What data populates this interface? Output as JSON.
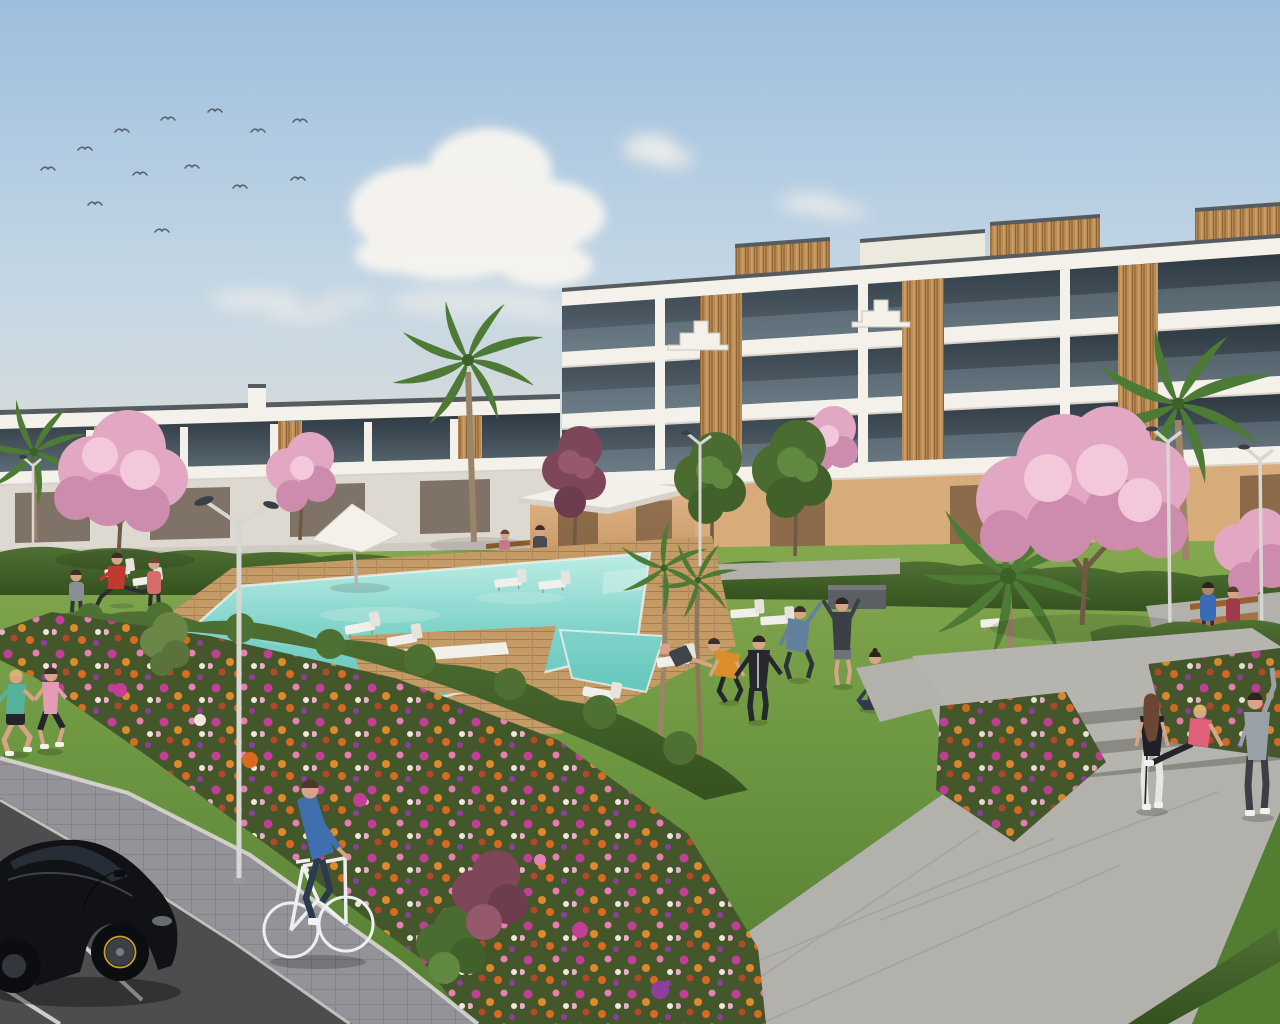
{
  "scene": {
    "type": "architectural-render",
    "description": "3D rendering of a modern white apartment complex with communal pool, timber deck, gardens, flower beds, parking lot and residents exercising",
    "environment": {
      "time_of_day": "late afternoon",
      "sky": {
        "top": "#9dbedd",
        "mid": "#c3d6e5",
        "horizon": "#ece4d7"
      },
      "clouds": [
        "large cumulus upper center-left",
        "small puffs right of center",
        "low wisps left"
      ],
      "birds_count": 13
    },
    "buildings": {
      "left_block": {
        "stories": 2,
        "style": "white terraced apartments with dark glazing and timber slat accents"
      },
      "right_block": {
        "stories": 3,
        "style": "white stacked balconies, glass balustrades, rooftop timber volumes, ochre ground floor"
      }
    },
    "amenities": {
      "pool": {
        "shape": "L-shaped with spa and timber platform",
        "deck": "wood"
      },
      "sun_loungers": 11,
      "parasols": 1,
      "benches": 3,
      "street_lamps": 5,
      "steps": "three wide stone steps with upper landing"
    },
    "vegetation": {
      "palm_trees": 5,
      "blossom_trees": 6,
      "green_trees": 5,
      "hedges": "trimmed dark green",
      "flower_field_colors": [
        "#c23e97",
        "#e08a2e",
        "#e77fb4",
        "#8e3f9e",
        "#efe7dd",
        "#b5472a"
      ]
    },
    "people": [
      {
        "id": "jogger-left",
        "activity": "jogging",
        "top": "#56b29b",
        "bottom": "#23252a",
        "hair": "#d9b36a"
      },
      {
        "id": "jogger-right",
        "activity": "jogging",
        "top": "#e39cb4",
        "bottom": "#23252a",
        "hair": "#3a2e27"
      },
      {
        "id": "cyclist",
        "activity": "cycling",
        "top": "#3f6fae",
        "bottom": "#2b3a4e",
        "hair": "#4a382c"
      },
      {
        "id": "walker-gray",
        "activity": "walking",
        "top": "#8a8f96",
        "bottom": "#32353a",
        "hair": "#3a2e27"
      },
      {
        "id": "lunge-stretcher",
        "activity": "stretching leg on lounger",
        "top": "#c03a30",
        "bottom": "#2b2d32",
        "hair": "#3a2e27"
      },
      {
        "id": "walker-coral",
        "activity": "walking",
        "top": "#d96a6a",
        "bottom": "#2b2d32",
        "hair": "#6b4632"
      },
      {
        "id": "bench-sitter",
        "activity": "sitting on bench",
        "top": "#d787a0",
        "bottom": "#3a3d42",
        "hair": "#6b4632"
      },
      {
        "id": "stander-with-bag",
        "activity": "standing with bag",
        "top": "#474b52",
        "bottom": "#5a5e64",
        "hair": "#3a2e27"
      },
      {
        "id": "recliner",
        "activity": "lying on deck chair",
        "top": "#3f444b",
        "bottom": "#d7a488",
        "hair": "#3a2e27"
      },
      {
        "id": "squatter",
        "activity": "warming up",
        "top": "#d98e2b",
        "bottom": "#23252a",
        "hair": "#3a2e27"
      },
      {
        "id": "tracksuit",
        "activity": "arm swings",
        "top": "#26282d",
        "bottom": "#26282d",
        "hair": "#2c241e"
      },
      {
        "id": "side-stretcher",
        "activity": "side bend stretch",
        "top": "#64809f",
        "bottom": "#2e3338",
        "hair": "#3a2e27"
      },
      {
        "id": "overhead-stretcher",
        "activity": "overhead stretch",
        "top": "#3c4046",
        "bottom": "#6d7277",
        "hair": "#2c241e"
      },
      {
        "id": "yoga-sitter",
        "activity": "seated yoga",
        "top": "#32394a",
        "bottom": "#32394a",
        "hair": "#2c241e"
      },
      {
        "id": "bench-man",
        "activity": "sitting on bench",
        "top": "#3a6bb5",
        "bottom": "#2b2d32",
        "hair": "#2c241e"
      },
      {
        "id": "bench-woman",
        "activity": "sitting on bench",
        "top": "#9e3a4a",
        "bottom": "#2b2d32",
        "hair": "#5a3a28"
      },
      {
        "id": "steps-standing-woman",
        "activity": "standing by steps",
        "top": "#1f2126",
        "bottom": "#e8e6e2",
        "hair": "#6b4632"
      },
      {
        "id": "steps-sitting-woman",
        "activity": "sitting on steps",
        "top": "#e0607a",
        "bottom": "#23252a",
        "hair": "#d9b36a"
      },
      {
        "id": "steps-stretcher",
        "activity": "arm raised stretch",
        "top": "#9aa0a8",
        "bottom": "#3c4046",
        "hair": "#2c241e"
      }
    ],
    "vehicles": {
      "car": {
        "type": "black hatchback",
        "body": "#101216",
        "glass": "#272d36",
        "rim_accent": "#c9a227"
      },
      "bicycle": {
        "frame": "#eceff1"
      }
    },
    "palette": {
      "white_wall": "#f4f1ea",
      "wall_shade": "#e2ddd4",
      "coping": "#565b60",
      "glass_dark": "#2e3942",
      "wood": "#c89a63",
      "tan_wall": "#d8ac7a",
      "tan_opening": "#7e5f42",
      "grass": "#7da64b",
      "hedge": "#47662e",
      "hedge_dark": "#36511f",
      "deck": "#c59a67",
      "water_far": "#c0efe7",
      "water_near": "#5fc4ba",
      "path_concrete": "#b3b1ac",
      "paver": "#95939a",
      "curb": "#d9d6cf",
      "step_top": "#b6b4af",
      "step_riser": "#8b8984",
      "asphalt": "#4d4d50",
      "marking": "#e6e5e1",
      "bed_green": "#44572b",
      "blossom": "#e2a7c2",
      "plum": "#7e4759",
      "palm": "#4d7a34",
      "tree_green": "#4a6c30",
      "trunk": "#9b8468",
      "bench_wood": "#a9713f",
      "lamp_head": "#3a3f45",
      "skin": "#d7a488",
      "car_body": "#101216",
      "bike": "#eceff1"
    }
  }
}
